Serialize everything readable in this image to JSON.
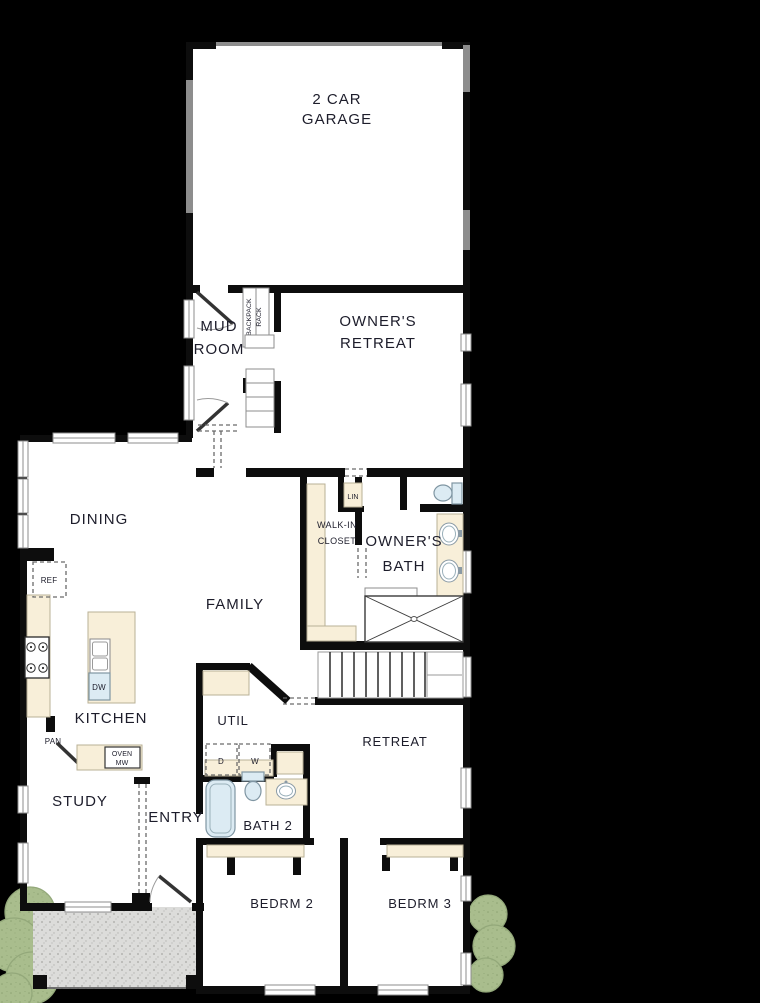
{
  "floor_plan": {
    "rooms": {
      "garage": {
        "line1": "2 CAR",
        "line2": "GARAGE"
      },
      "mud_room": {
        "line1": "MUD",
        "line2": "ROOM"
      },
      "backpack_rack": {
        "line1": "BACKPACK",
        "line2": "RACK"
      },
      "owners_retreat": {
        "line1": "OWNER'S",
        "line2": "RETREAT"
      },
      "dining": {
        "label": "DINING"
      },
      "walk_in_closet": {
        "line1": "WALK-IN",
        "line2": "CLOSET"
      },
      "linen": {
        "label": "LIN"
      },
      "owners_bath": {
        "line1": "OWNER'S",
        "line2": "BATH"
      },
      "family": {
        "label": "FAMILY"
      },
      "kitchen": {
        "label": "KITCHEN"
      },
      "util": {
        "label": "UTIL"
      },
      "retreat": {
        "label": "RETREAT"
      },
      "study": {
        "label": "STUDY"
      },
      "entry": {
        "label": "ENTRY"
      },
      "bath2": {
        "label": "BATH 2"
      },
      "bedroom2": {
        "label": "BEDRM 2"
      },
      "bedroom3": {
        "label": "BEDRM 3"
      }
    },
    "appliances": {
      "refrigerator": "REF",
      "dishwasher": "DW",
      "pantry": "PAN",
      "oven_line1": "OVEN",
      "oven_line2": "MW",
      "dryer": "D",
      "washer": "W"
    },
    "colors": {
      "background": "#000000",
      "wall": "#0d0d0d",
      "floor": "#ffffff",
      "counter": "#f8efd9",
      "fixture_blue": "#dcebf3",
      "porch": "#dcdcda",
      "bush": "#a9bd8d",
      "text": "#1d1d2b"
    }
  }
}
